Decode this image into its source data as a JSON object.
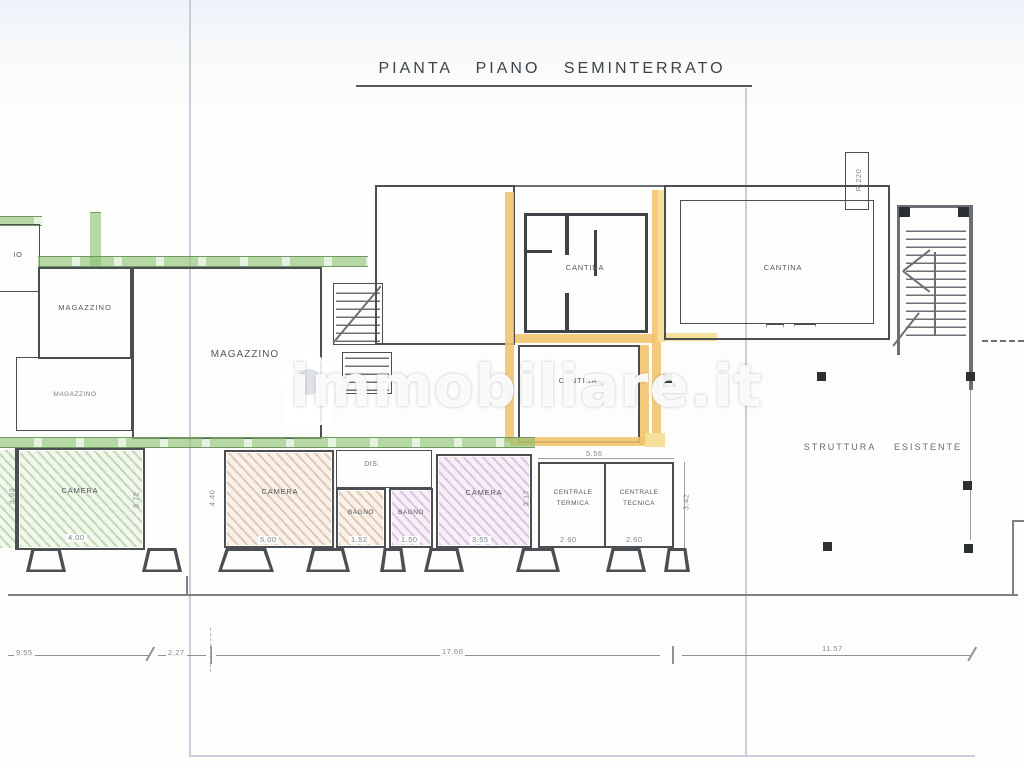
{
  "title": "PIANTA PIANO SEMINTERRATO",
  "watermark": {
    "text": "immobiliare.it",
    "icon": "house-icon"
  },
  "labels": {
    "magazzino_edge": "IO",
    "magazzino_1": "MAGAZZINO",
    "magazzino_small": "MAGAZZINO",
    "magazzino_2": "MAGAZZINO",
    "cantina_upper": "CANTINA",
    "cantina_lower": "CANTINA",
    "cantina_right": "CANTINA",
    "shaft": "R.220",
    "camera_green": "CAMERA",
    "camera_brown": "CAMERA",
    "camera_purple": "CAMERA",
    "bagno_left": "BAGNO",
    "bagno_right": "BAGNO",
    "dis": "DIS.",
    "centrale_termica_line1": "CENTRALE",
    "centrale_termica_line2": "TERMICA",
    "centrale_tecnica_line1": "CENTRALE",
    "centrale_tecnica_line2": "TECNICA",
    "struttura_word1": "STRUTTURA",
    "struttura_word2": "ESISTENTE"
  },
  "dims": {
    "bottom_seg1": "9.55",
    "bottom_seg2": "2.27",
    "bottom_seg3": "17.60",
    "bottom_seg4": "11.57",
    "camera_green_left": "3.93",
    "camera_green_right": "3.72",
    "camera_green_bottom": "4.00",
    "camera_brown_left": "4.40",
    "camera_brown_bottom": "5.00",
    "bagno_left_bottom": "1.52",
    "bagno_right_bottom": "1.50",
    "camera_purple_bottom": "3.55",
    "camera_purple_right": "3.17",
    "centrali_top": "5.56",
    "centrale_termica_bottom": "2.60",
    "centrale_tecnica_bottom": "2.60",
    "centrali_right": "3.42"
  },
  "colors": {
    "wall": "#4b4f54",
    "green_highlight": "#8bc170",
    "orange_highlight": "#f2c169",
    "yellow_highlight": "#f4e09b",
    "purple_fill": "#ae68ba",
    "brown_fill": "#bd7c4e"
  }
}
